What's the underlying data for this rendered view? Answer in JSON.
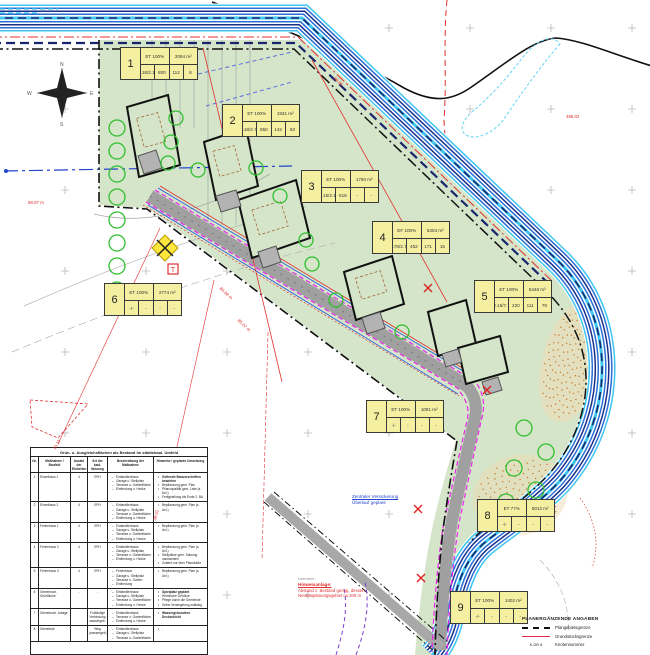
{
  "map": {
    "compass": {
      "n": "N",
      "e": "E",
      "s": "S",
      "w": "W"
    },
    "symbols": {
      "t_label": "T"
    },
    "colors": {
      "site_green": "#d4e5c9",
      "stream_cyan": "#3fc6ef",
      "stream_blue": "#2a6fd6",
      "stream_navy": "#1a2f8a",
      "road_gray": "#a0a0a0",
      "magenta": "#ea24ea",
      "survey_red": "#e03030",
      "tree_green": "#2fbf2f",
      "lot_yellow": "#f5efa2",
      "stipple_orange": "#c8782a"
    },
    "lots": [
      {
        "no": "1",
        "gfz": "ET 100%",
        "area": "2094 m²",
        "r2": [
          "2.18/2.17",
          "800",
          "112",
          "8"
        ],
        "x": 120,
        "y": 47
      },
      {
        "no": "2",
        "gfz": "ET 100%",
        "area": "1931 m²",
        "r2": [
          "2.18/2.71",
          "850",
          "142",
          "83"
        ],
        "x": 222,
        "y": 104
      },
      {
        "no": "3",
        "gfz": "ET 100%",
        "area": "1760 m²",
        "r2": [
          "2.15/2.11",
          "818",
          "-",
          "-"
        ],
        "x": 301,
        "y": 170
      },
      {
        "no": "4",
        "gfz": "EF 100%",
        "area": "5303 m²",
        "r2": [
          "2.78/2.71",
          "452",
          "171",
          "15"
        ],
        "x": 372,
        "y": 221
      },
      {
        "no": "5",
        "gfz": "ET 100%",
        "area": "5448 m²",
        "r2": [
          "2.15/7.1",
          "220",
          "111",
          "79"
        ],
        "x": 474,
        "y": 280
      },
      {
        "no": "6",
        "gfz": "ET 100%",
        "area": "2774 m²",
        "r2": [
          "-/-",
          "-",
          "-",
          "-"
        ],
        "x": 104,
        "y": 283
      },
      {
        "no": "7",
        "gfz": "ET 100%",
        "area": "1081 m²",
        "r2": [
          "-/-",
          "-",
          "-",
          "-"
        ],
        "x": 366,
        "y": 400
      },
      {
        "no": "8",
        "gfz": "ET 77%",
        "area": "5012 m²",
        "r2": [
          "-/-",
          "-",
          "-",
          "-"
        ],
        "x": 477,
        "y": 499
      },
      {
        "no": "9",
        "gfz": "ET 100%",
        "area": "1402 m²",
        "r2": [
          "-/-",
          "-",
          "-",
          "-"
        ],
        "x": 450,
        "y": 591
      }
    ],
    "red_labels": [
      {
        "x": 28,
        "y": 200,
        "t": "88.97 m",
        "rot": 0
      },
      {
        "x": 336,
        "y": 76,
        "t": "88.85",
        "rot": 43
      },
      {
        "x": 566,
        "y": 114,
        "t": "485.02",
        "rot": 0
      },
      {
        "x": 222,
        "y": 286,
        "t": "86.09 m",
        "rot": 43
      },
      {
        "x": 240,
        "y": 318,
        "t": "85.07 m",
        "rot": 43
      },
      {
        "x": 52,
        "y": 448,
        "t": "45.11",
        "rot": -62
      },
      {
        "x": 152,
        "y": 520,
        "t": "38.02",
        "rot": -75
      }
    ],
    "notes": {
      "infiltration_l1": "Zentraler Versickerung",
      "infiltration_l2": "Überlauf geplant",
      "noise_l1": "Leerrohre",
      "noise_l2": "Hinweisanlage:",
      "noise_l3": "Abstand z. Bestand gering, dessen",
      "noise_l4": "Neubauplanungsgebiet ca 200 m"
    }
  },
  "table": {
    "title": "Grün- u. Ausgleichsflächen als Bestand im städtebaul. Umfeld",
    "headers": [
      "Nr.",
      "Maßnahme / Baufeld",
      "Anzahl der Einheiten",
      "Art der baul. Nutzung",
      "Beschreibung der Maßnahme",
      "Hinweise / geplante Umsetzung"
    ],
    "rows": [
      {
        "nr": "1",
        "name": "Einzelhaus 1",
        "count": "4",
        "type": "EFH",
        "desc": [
          "Einfamilienhaus",
          "Garage u. Stellplatz",
          "Terrasse u. Gartenfläche",
          "Einfriedung u. Hecke"
        ],
        "notes": [
          "Geltende Bauvorschriften beachten",
          "Bepflanzung gem. Plan",
          "Pflanzqualität gem. Liste (s. Anl.)",
          "Fertigstellung bis Ende 2. BA"
        ],
        "notes_bold": true
      },
      {
        "nr": "2",
        "name": "Einzelhaus 2",
        "count": "4",
        "type": "EFH",
        "desc": [
          "Einfamilienhaus",
          "Garage u. Stellplatz",
          "Terrasse u. Gartenfläche",
          "Einfriedung u. Hecke"
        ],
        "notes": [
          "Bepflanzung gem. Plan (s. Anl.)"
        ],
        "notes_bold": false
      },
      {
        "nr": "3",
        "name": "Ferienhaus 1",
        "count": "4",
        "type": "EFH",
        "desc": [
          "Einfamilienhaus",
          "Garage u. Stellplatz",
          "Terrasse u. Gartenfläche",
          "Einfriedung u. Hecke"
        ],
        "notes": [
          "Bepflanzung gem. Plan (s. Anl.)"
        ],
        "notes_bold": false
      },
      {
        "nr": "4",
        "name": "Ferienhaus 2",
        "count": "4",
        "type": "EFH",
        "desc": [
          "Einfamilienhaus",
          "Garage u. Stellplatz",
          "Terrasse u. Gartenfläche",
          "Einfriedung u. Hecke"
        ],
        "notes": [
          "Bepflanzung gem. Plan (s. Anl.)",
          "Stellplätze gem. Satzung nachweisen",
          "Zufahrt nur über Planstraße"
        ],
        "notes_bold": false
      },
      {
        "nr": "5",
        "name": "Ferienhaus 3",
        "count": "4",
        "type": "EFH",
        "desc": [
          "Ferienhaus",
          "Garage u. Stellplatz",
          "Terrasse u. Garten",
          "Einfriedung"
        ],
        "notes": [
          "Bepflanzung gem. Plan (s. Anl.)"
        ],
        "notes_bold": false
      },
      {
        "nr": "6",
        "name": "Gemeinsch. Grünfläche",
        "count": "-",
        "type": "-",
        "desc": [
          "Einfamilienhaus",
          "Garage u. Stellplatz",
          "Terrasse u. Gartenfläche",
          "Einfriedung u. Hecke"
        ],
        "notes": [
          "Spielplatz geplant",
          "Heimische Gehölze",
          "Pflege durch die Gemeinde",
          "Keine Versiegelung zulässig"
        ],
        "notes_bold": true
      },
      {
        "nr": "7",
        "name": "Gemeinsch. Anlage",
        "count": "",
        "type": "Fußläufige Verbindung wassergeb.",
        "desc": [
          "Einfamilienhaus",
          "Terrasse u. Gartenfläche",
          "Einfriedung u. Hecke"
        ],
        "notes": [
          "Wassergebundene Deckschicht"
        ],
        "notes_bold": true
      },
      {
        "nr": "8",
        "name": "Gemeinde",
        "count": "",
        "type": "Weg (wassergeb.)",
        "desc": [
          "Einfamilienhaus",
          "Garage u. Stellplatz",
          "Terrasse u. Gartenfläche"
        ],
        "notes": [
          "-"
        ],
        "notes_bold": false
      }
    ]
  },
  "legend": {
    "title": "PLANERGÄNZENDE ANGABEN",
    "items": [
      {
        "swatch": "dashdot",
        "symbol": "",
        "label": "Plangebietsgrenze"
      },
      {
        "swatch": "redline",
        "symbol": "",
        "label": "Grundstücksgrenze"
      },
      {
        "swatch": "ktext",
        "symbol": "K-GR 8",
        "label": "Knotennummer"
      }
    ]
  }
}
